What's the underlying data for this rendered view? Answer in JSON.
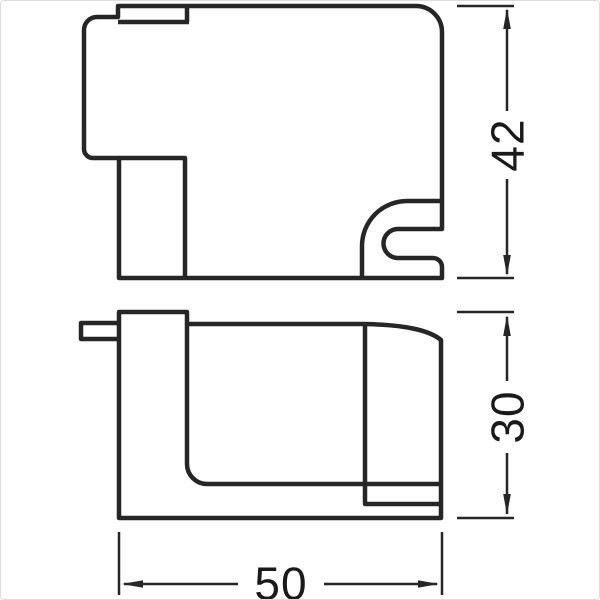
{
  "diagram": {
    "kind": "technical-dimension-drawing",
    "colors": {
      "line": "#262626",
      "dimension_line": "#262626",
      "text": "#1a1a1a",
      "background": "#ffffff",
      "frame": "#dcdcdc"
    },
    "views": [
      {
        "id": "top-view",
        "description": "side profile with top clip tab, left mounting foot and C-shaped snap hook at lower right"
      },
      {
        "id": "front-view",
        "description": "front profile with small left tab, vertical foot column and rounded right end"
      }
    ],
    "dimensions": {
      "side_height": {
        "value": "42",
        "orientation": "vertical"
      },
      "front_height": {
        "value": "30",
        "orientation": "vertical"
      },
      "width": {
        "value": "50",
        "orientation": "horizontal"
      }
    }
  }
}
